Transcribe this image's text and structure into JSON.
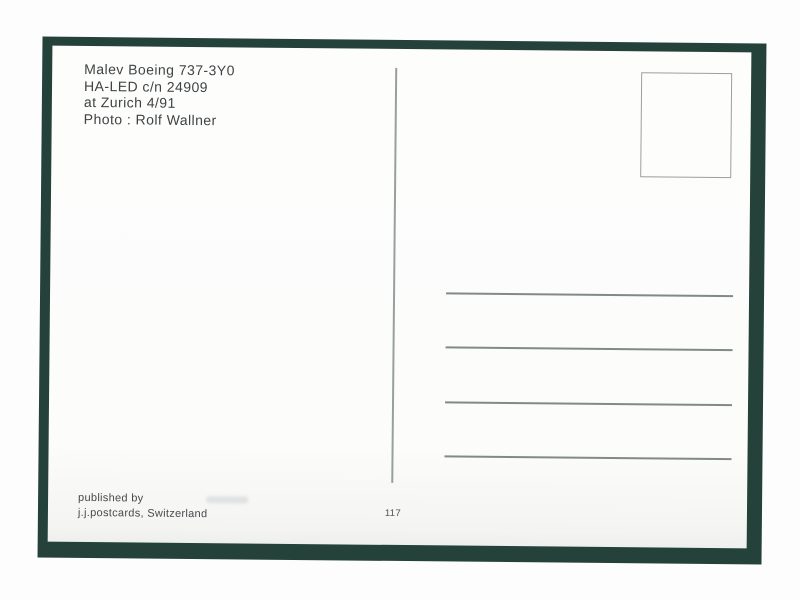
{
  "caption": {
    "lines": [
      "Malev Boeing 737-3Y0",
      "HA-LED c/n 24909",
      "at Zurich 4/91",
      "Photo : Rolf Wallner"
    ]
  },
  "publisher": {
    "lines": [
      "published by",
      "j.j.postcards, Switzerland"
    ]
  },
  "card_number": "117",
  "colors": {
    "mat_green": "#24423a",
    "card_white": "#fcfcfb",
    "rule_gray": "#818a88",
    "frame_gray": "#98a09e",
    "text_dark": "#3f4346",
    "page_white": "#fdfdfd"
  }
}
